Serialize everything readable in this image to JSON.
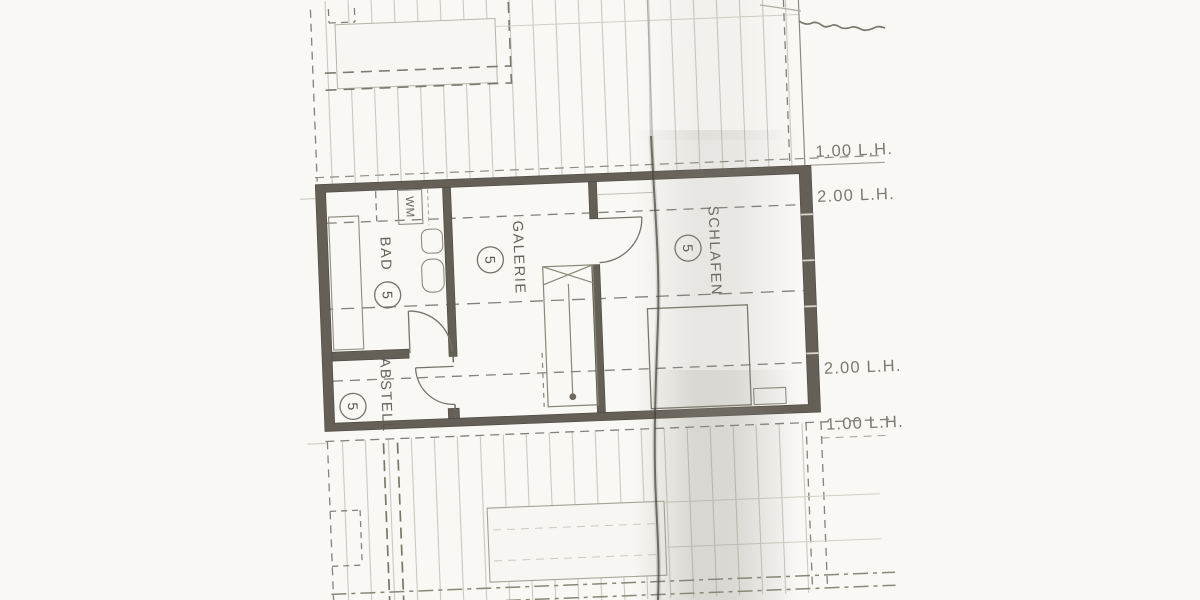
{
  "drawing": {
    "unit_number": "5",
    "rooms": [
      {
        "id": "bad",
        "label": "BAD",
        "number": "5"
      },
      {
        "id": "galerie",
        "label": "GALERIE",
        "number": "5"
      },
      {
        "id": "schlafen",
        "label": "SCHLAFEN",
        "number": "5"
      },
      {
        "id": "abstell",
        "label": "ABSTELL",
        "number": "5"
      }
    ],
    "appliance_label": "WM",
    "height_annotations": [
      {
        "id": "top",
        "text": "1.00 L.H."
      },
      {
        "id": "upper",
        "text": "2.00 L.H."
      },
      {
        "id": "lower",
        "text": "2.00 L.H."
      },
      {
        "id": "bottom",
        "text": "1.00 L.H."
      }
    ],
    "colors": {
      "paper": "#f8f7f3",
      "ink": "#6e6a61",
      "wall": "#645f57",
      "hatch": "#cbc7be",
      "label": "#5b574e",
      "fold": "#45423c",
      "shadow": "#8d897f"
    }
  }
}
